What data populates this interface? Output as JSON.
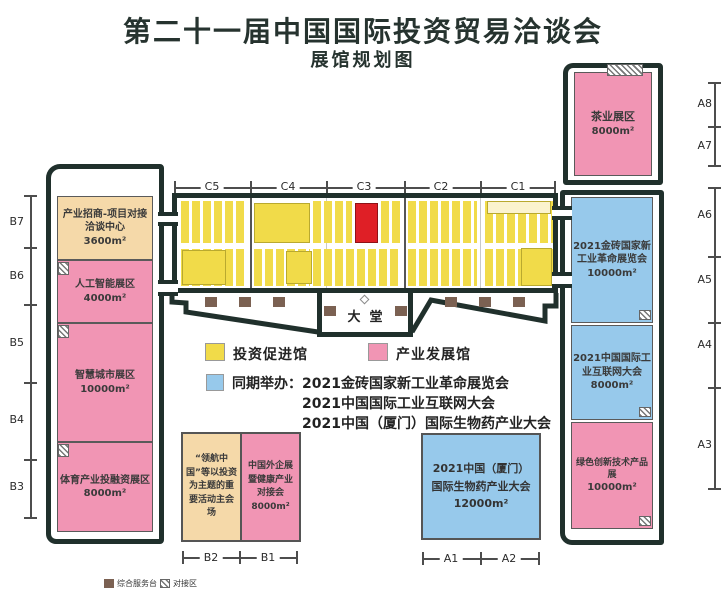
{
  "title": "第二十一届中国国际投资贸易洽谈会",
  "subtitle": "展馆规划图",
  "colors": {
    "investment_hall_yellow": "#F1DB49",
    "industry_hall_pink": "#F195B4",
    "concurrent_blue": "#97C9EB",
    "reception_tan": "#F5D9A9",
    "highlight_red": "#DF1F26",
    "building_outline": "#20302C",
    "service_desk_brown": "#7B6152"
  },
  "rulers": {
    "c": [
      "C5",
      "C4",
      "C3",
      "C2",
      "C1"
    ],
    "b_side": [
      "B7",
      "B6",
      "B5",
      "B4",
      "B3"
    ],
    "a_top": [
      "A8",
      "A7"
    ],
    "a_side": [
      "A6",
      "A5",
      "A4",
      "A3"
    ],
    "b_bottom": [
      "B2",
      "B1"
    ],
    "a_bottom": [
      "A1",
      "A2"
    ]
  },
  "west": {
    "blocks": [
      {
        "label": "产业招商-项目对接洽谈中心",
        "area": "3600m²"
      },
      {
        "label": "人工智能展区",
        "area": "4000m²"
      },
      {
        "label": "智慧城市展区",
        "area": "10000m²"
      },
      {
        "label": "体育产业投融资展区",
        "area": "8000m²"
      }
    ]
  },
  "northeast": {
    "label": "茶业展区",
    "area": "8000m²"
  },
  "east": {
    "blocks": [
      {
        "label": "2021金砖国家新工业革命展览会",
        "area": "10000m²"
      },
      {
        "label": "2021中国国际工业互联网大会",
        "area": "8000m²"
      },
      {
        "label": "绿色创新技术产品展",
        "area": "10000m²"
      }
    ]
  },
  "lobby": {
    "label": "大堂"
  },
  "south_b": {
    "main_venue": "“领航中国”等以投资为主题的重要活动主会场",
    "foreign": "中国外企展暨健康产业对接会",
    "foreign_area": "8000m²"
  },
  "south_a": {
    "line1": "2021中国（厦门）",
    "line2": "国际生物药产业大会",
    "area": "12000m²"
  },
  "legend": {
    "yellow": "投资促进馆",
    "pink": "产业发展馆",
    "blue_prefix": "同期举办：",
    "blue_lines": [
      "2021金砖国家新工业革命展览会",
      "2021中国国际工业互联网大会",
      "2021中国（厦门）国际生物药产业大会"
    ]
  },
  "footer": {
    "service": "综合服务台",
    "matching": "对接区"
  }
}
